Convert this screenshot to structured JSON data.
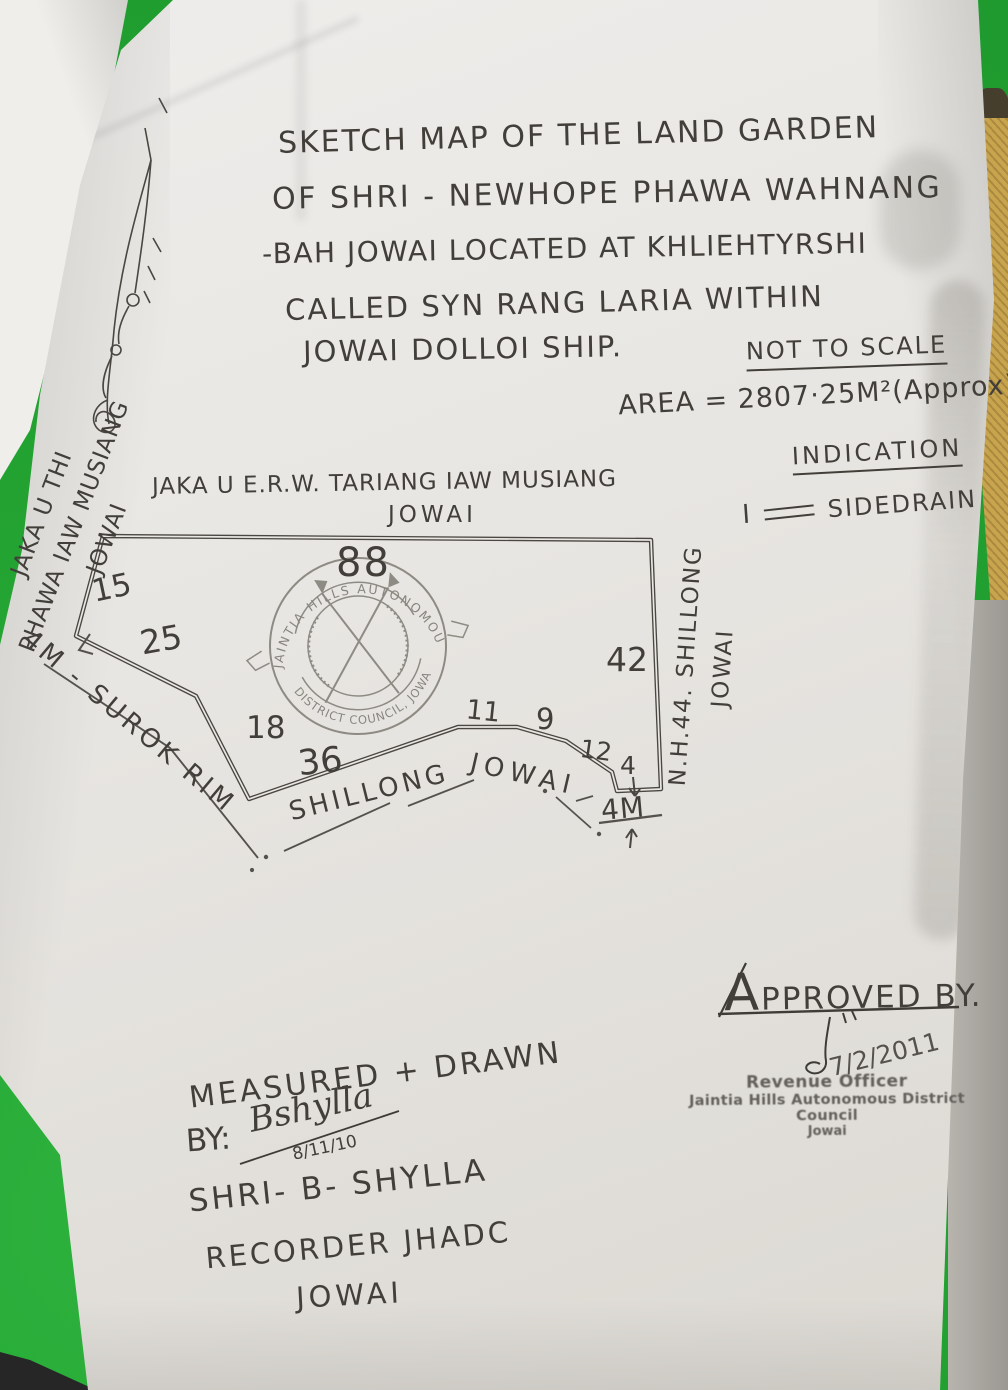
{
  "photo": {
    "background_color": "#23a331",
    "paper_color": "#e9e7e2",
    "pencil_color": "#423f3a",
    "stamp_ink_color": "#6e6b63",
    "side_object_color": "#c8a44e"
  },
  "title": {
    "lines": [
      "SKETCH MAP OF THE LAND GARDEN",
      "OF SHRI - NEWHOPE PHAWA WAHNANG",
      "-BAH JOWAI LOCATED AT KHLIEHTYRSHI",
      "CALLED SYN RANG LARIA WITHIN",
      "JOWAI DOLLOI SHIP."
    ],
    "scale_note": "NOT TO SCALE",
    "area_note": "AREA = 2807·25M²(Approx)"
  },
  "indication": {
    "heading": "INDICATION",
    "item_number": "I",
    "symbol": "double-line",
    "label": "SIDEDRAIN"
  },
  "map": {
    "north_boundary_label_line1": "JAKA U E.R.W. TARIANG IAW MUSIANG",
    "north_boundary_label_line2": "JOWAI",
    "west_boundary_label_lines": [
      "JAKA U THI",
      "PHAWA IAW MUSIANG",
      "JOWAI"
    ],
    "east_boundary_label_line1": "N.H.44. SHILLONG",
    "east_boundary_label_line2": "JOWAI",
    "southwest_road_label": "4M - SUROK RIM",
    "south_road_label_word1": "SHILLONG",
    "south_road_label_word2": "JOWAI",
    "road_width_label": "4M",
    "measurements": {
      "top": "88",
      "left": "15",
      "upper_left": "25",
      "lower_left": "18",
      "bottom_long": "36",
      "bottom_a": "11",
      "bottom_b": "9",
      "bottom_c": "12",
      "bottom_d": "4",
      "right": "42"
    },
    "seal": {
      "top_text": "JAINTIA HILLS AUTONOMOUS",
      "bottom_text": "DISTRICT COUNCIL, JOWAI"
    }
  },
  "approval": {
    "heading": "APPROVED BY.",
    "date": "7/2/2011",
    "stamp_lines": [
      "Revenue Officer",
      "Jaintia Hills Autonomous District Council",
      "Jowai"
    ]
  },
  "measured_by": {
    "line1": "MEASURED + DRAWN",
    "line2": "BY:",
    "signature": "Bshylla",
    "signature_date": "8/11/10",
    "name": "SHRI- B- SHYLLA",
    "designation": "RECORDER JHADC",
    "place": "JOWAI"
  }
}
